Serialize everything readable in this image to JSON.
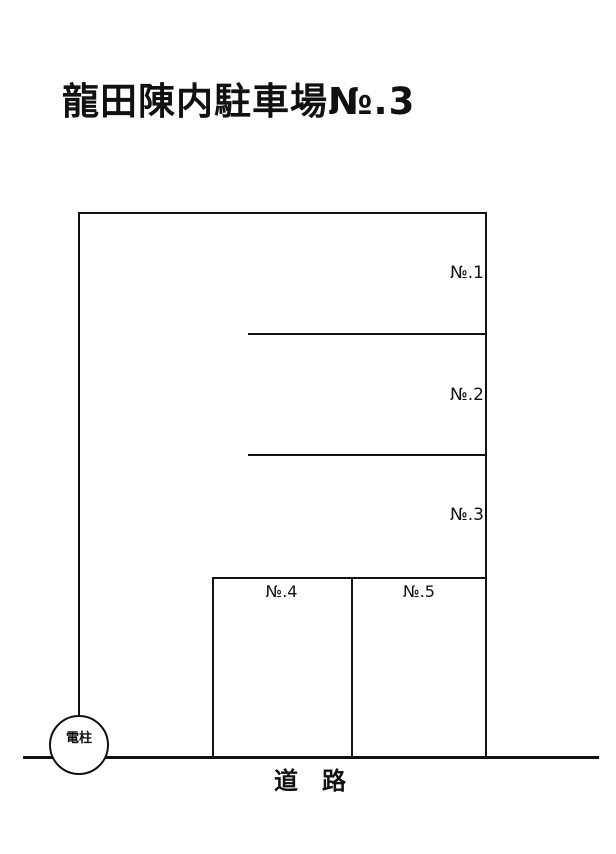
{
  "page": {
    "title": "龍田陳内駐車場№.3",
    "background": "#ffffff",
    "line_color": "#111111",
    "text_color": "#111111"
  },
  "parking": {
    "spaces": [
      {
        "label": "№.1"
      },
      {
        "label": "№.2"
      },
      {
        "label": "№.3"
      },
      {
        "label": "№.4"
      },
      {
        "label": "№.5"
      }
    ],
    "pole_label": "電柱",
    "road_label": "道　路"
  }
}
